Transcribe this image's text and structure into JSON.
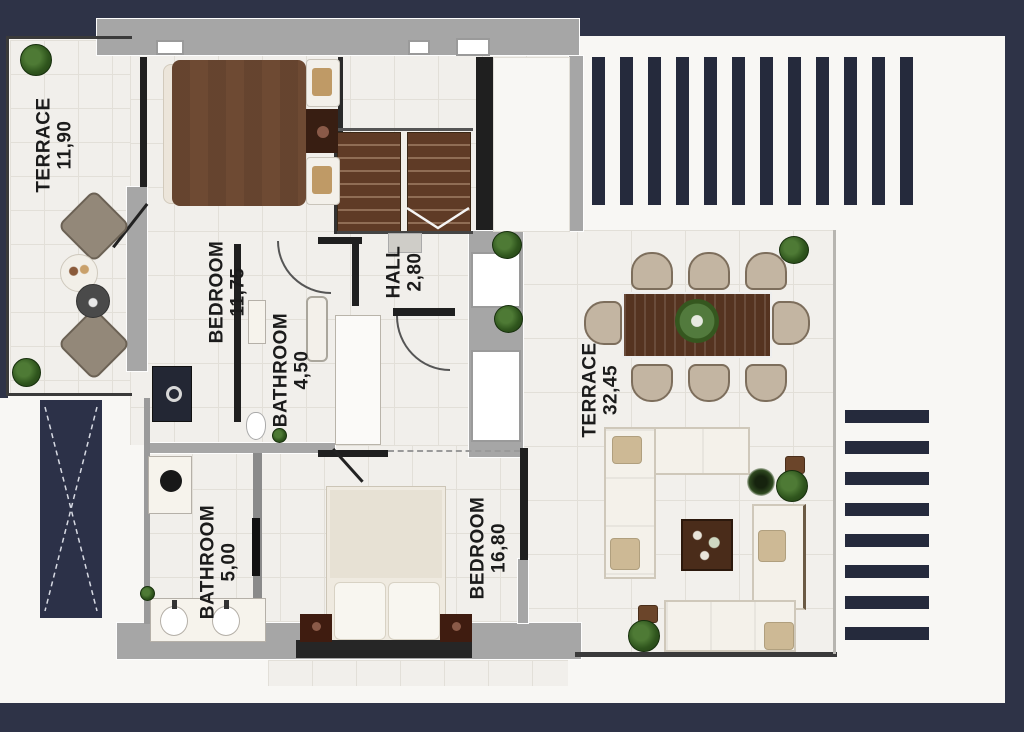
{
  "rooms": [
    {
      "id": "terrace-left",
      "name": "TERRACE",
      "area": "11,90"
    },
    {
      "id": "bedroom-top",
      "name": "BEDROOM",
      "area": "11,75"
    },
    {
      "id": "hall",
      "name": "HALL",
      "area": "2,80"
    },
    {
      "id": "bathroom-top",
      "name": "BATHROOM",
      "area": "4,50"
    },
    {
      "id": "bathroom-bottom",
      "name": "BATHROOM",
      "area": "5,00"
    },
    {
      "id": "bedroom-bottom",
      "name": "BEDROOM",
      "area": "16,80"
    },
    {
      "id": "terrace-right",
      "name": "TERRACE",
      "area": "32,45"
    }
  ],
  "features": {
    "pergola_slats_top_count": 12,
    "pergola_slats_side_count": 8,
    "stair_flights": 2,
    "dining_chair_count": 8,
    "void_shaft_marker": "dashed-x"
  },
  "furniture": [
    "double-bed-brown",
    "bed-cream",
    "dining-table-with-8-chairs",
    "plant-centerpiece",
    "sectional-sofa",
    "coffee-table",
    "green-pouf",
    "lounge-chairs",
    "round-side-tables",
    "washing-machine",
    "laundry-appliance",
    "double-sink-vanity",
    "bathtub",
    "shower-screen",
    "toilet",
    "staircase-two-flights",
    "potted-plants"
  ],
  "colors": {
    "frame": "#2e3347",
    "slat": "#252a3c",
    "paper": "#f8f7f4",
    "wall_gray": "#a6a6a6",
    "wall_black": "#1f1f1f",
    "stair_wood": "#5f3b26",
    "table_wood": "#553320",
    "bed_brown": "#6e4a33",
    "chair_tan": "#c3b5a2",
    "plant_green": "#2f551d",
    "sofa_cream": "#f4f1ea"
  }
}
